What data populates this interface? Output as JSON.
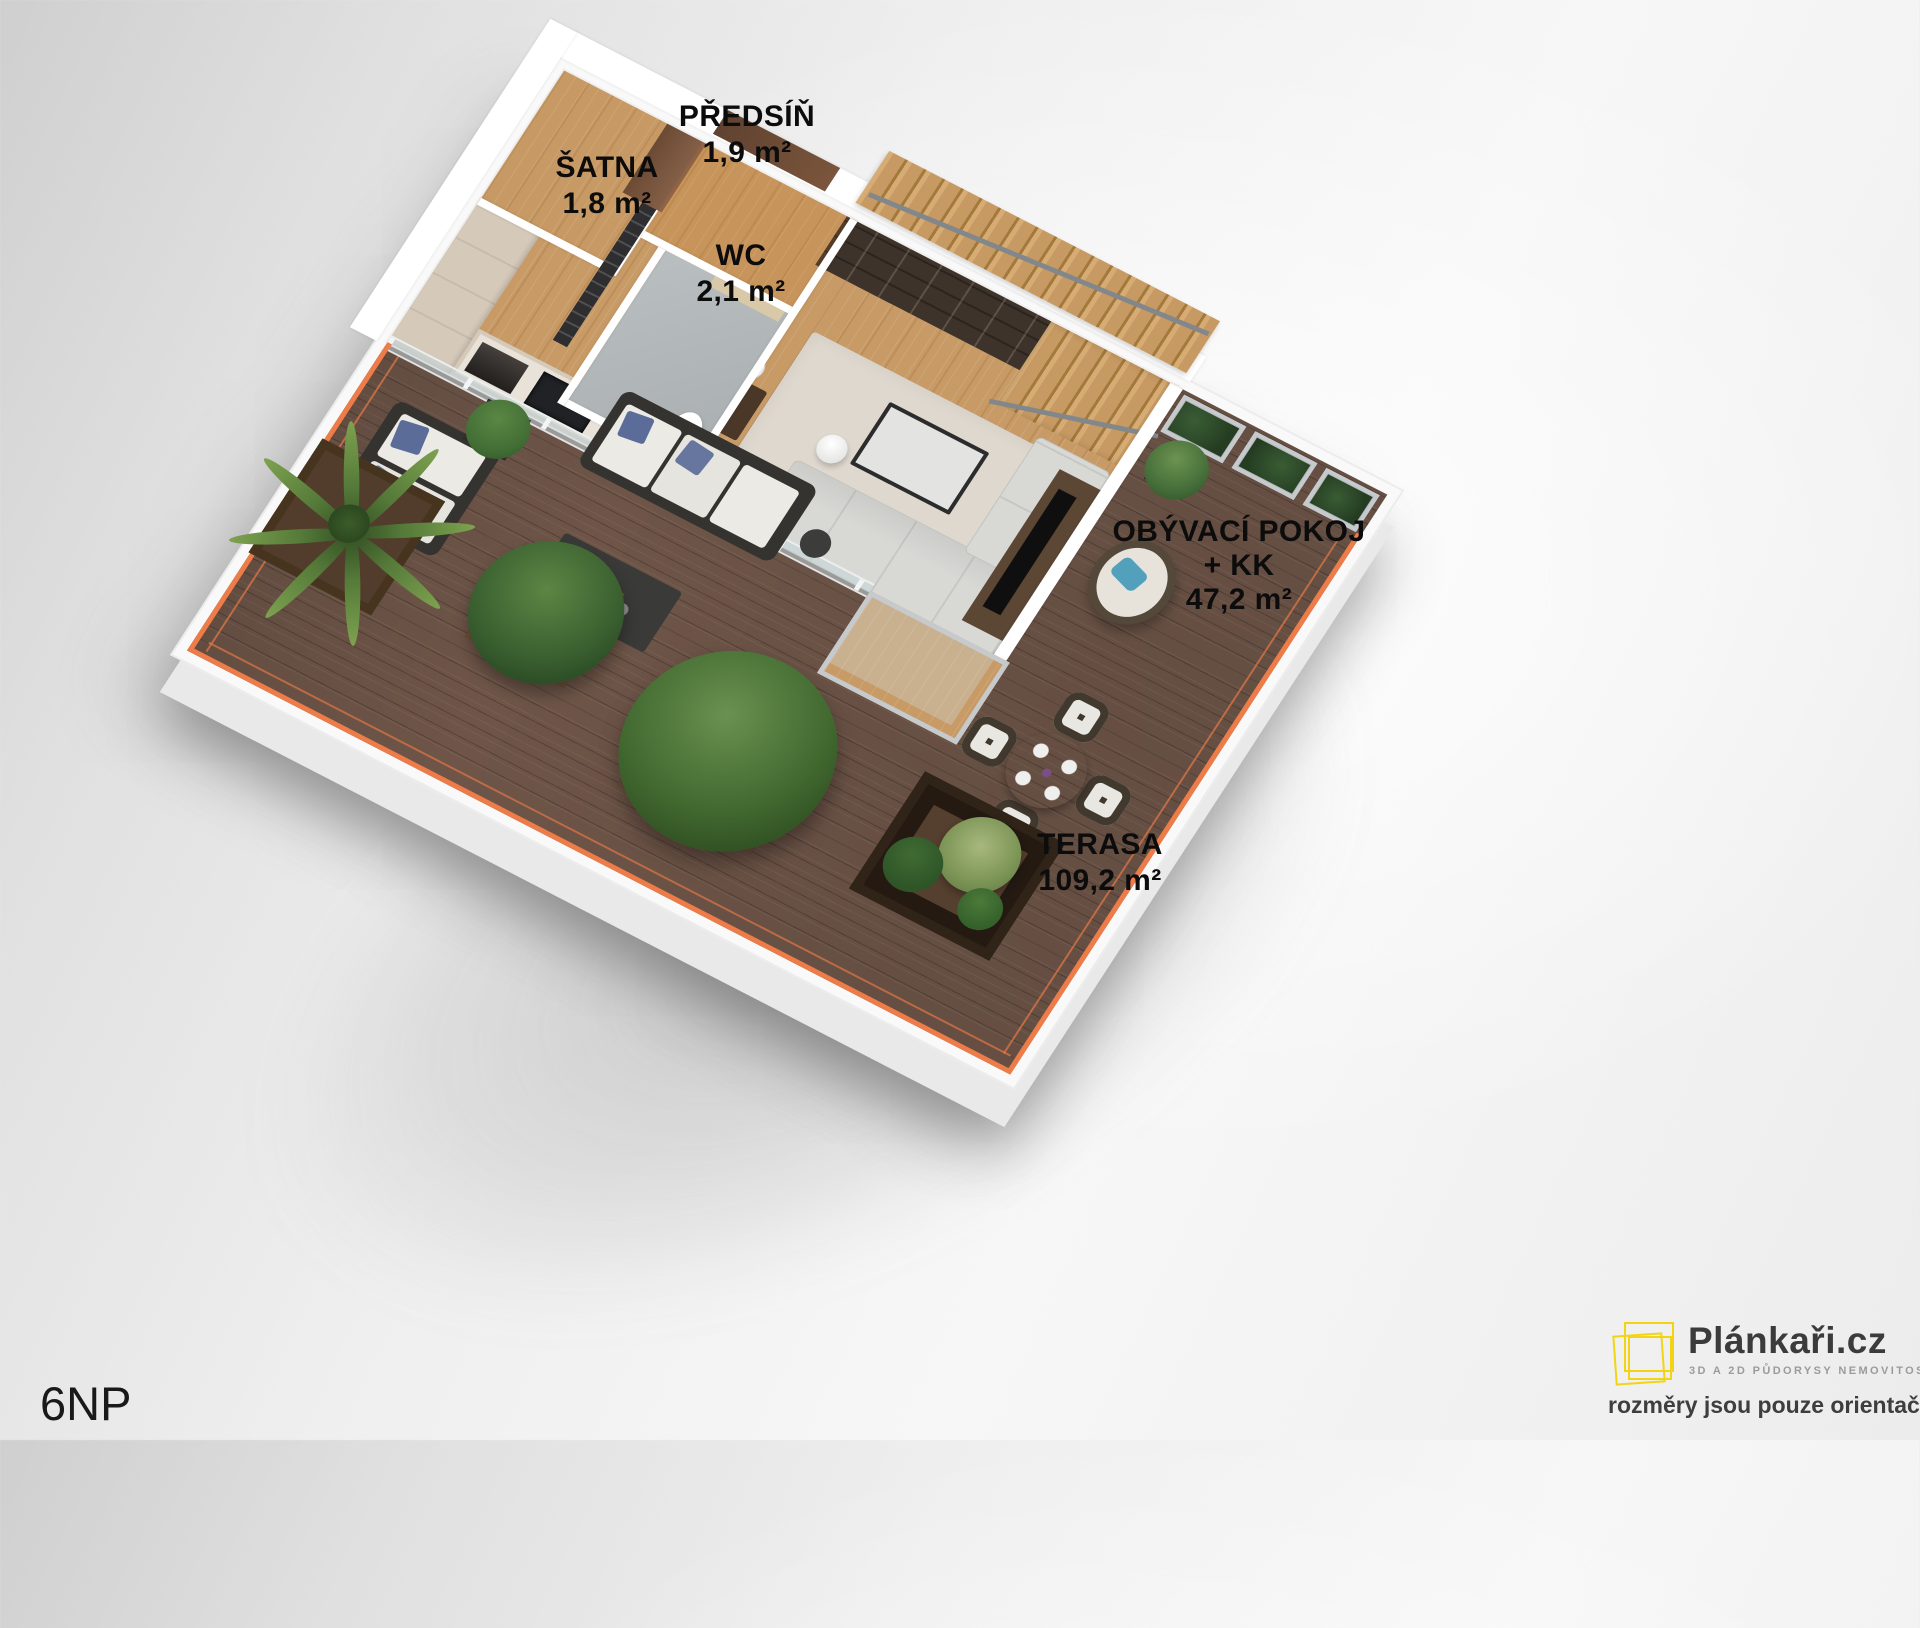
{
  "plan": {
    "floor_label": "6NP",
    "rooms": [
      {
        "title": "ŠATNA",
        "sub1": "1,8 m²",
        "sub2": ""
      },
      {
        "title": "PŘEDSÍŇ",
        "sub1": "1,9 m²",
        "sub2": ""
      },
      {
        "title": "WC",
        "sub1": "2,1 m²",
        "sub2": ""
      },
      {
        "title": "OBÝVACÍ POKOJ",
        "sub1": "+ KK",
        "sub2": "47,2 m²"
      },
      {
        "title": "TERASA",
        "sub1": "109,2 m²",
        "sub2": ""
      }
    ]
  },
  "branding": {
    "brand": "Plánkaři.cz",
    "tagline": "3D A 2D PŮDORYSY NEMOVITOSTÍ",
    "disclaimer": "rozměry jsou pouze orientační"
  },
  "colors": {
    "railing_orange": "#ee7c48",
    "logo_yellow": "#f2d414",
    "interior_wood": "#c79a66",
    "terrace_wood": "#6e5548",
    "label_text": "#0c0c0c"
  },
  "icons": [
    {
      "name": "plankari-logo-squares-icon",
      "shape": "overlapping-square-outlines",
      "color": "#f2d414"
    }
  ]
}
